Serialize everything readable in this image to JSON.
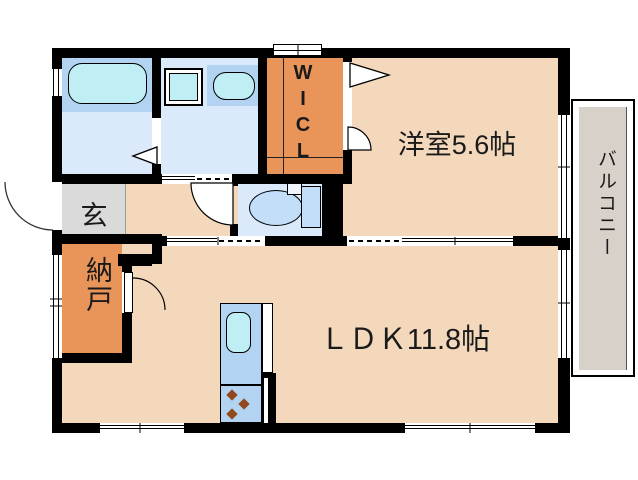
{
  "plan": {
    "type": "apartment-floorplan",
    "rooms": {
      "western_room": {
        "label": "洋室5.6帖"
      },
      "ldk": {
        "label": "ＬＤＫ11.8帖"
      },
      "balcony": {
        "label": "バルコニー"
      },
      "entrance": {
        "label": "玄"
      },
      "storage": {
        "label": "納戸"
      },
      "walk_in_closet": {
        "label": "WICL",
        "letters": [
          "W",
          "I",
          "C",
          "L"
        ]
      }
    },
    "fixtures": [
      "bathtub",
      "washing-machine",
      "vanity-sink",
      "toilet",
      "kitchen-sink",
      "stove-burners"
    ],
    "colors": {
      "wall": "#000000",
      "floor-peach": "#f3d8bb",
      "closet-orange": "#e9955a",
      "wet-floor-blue": "#dbeafa",
      "counter-blue": "#b2d4f2",
      "fixture-cyan": "#c0eef5",
      "toilet-fill": "#c2def8",
      "entry-gray": "#dadada",
      "balcony-gray": "#d7d1c9",
      "burner-brown": "#90481c"
    }
  }
}
